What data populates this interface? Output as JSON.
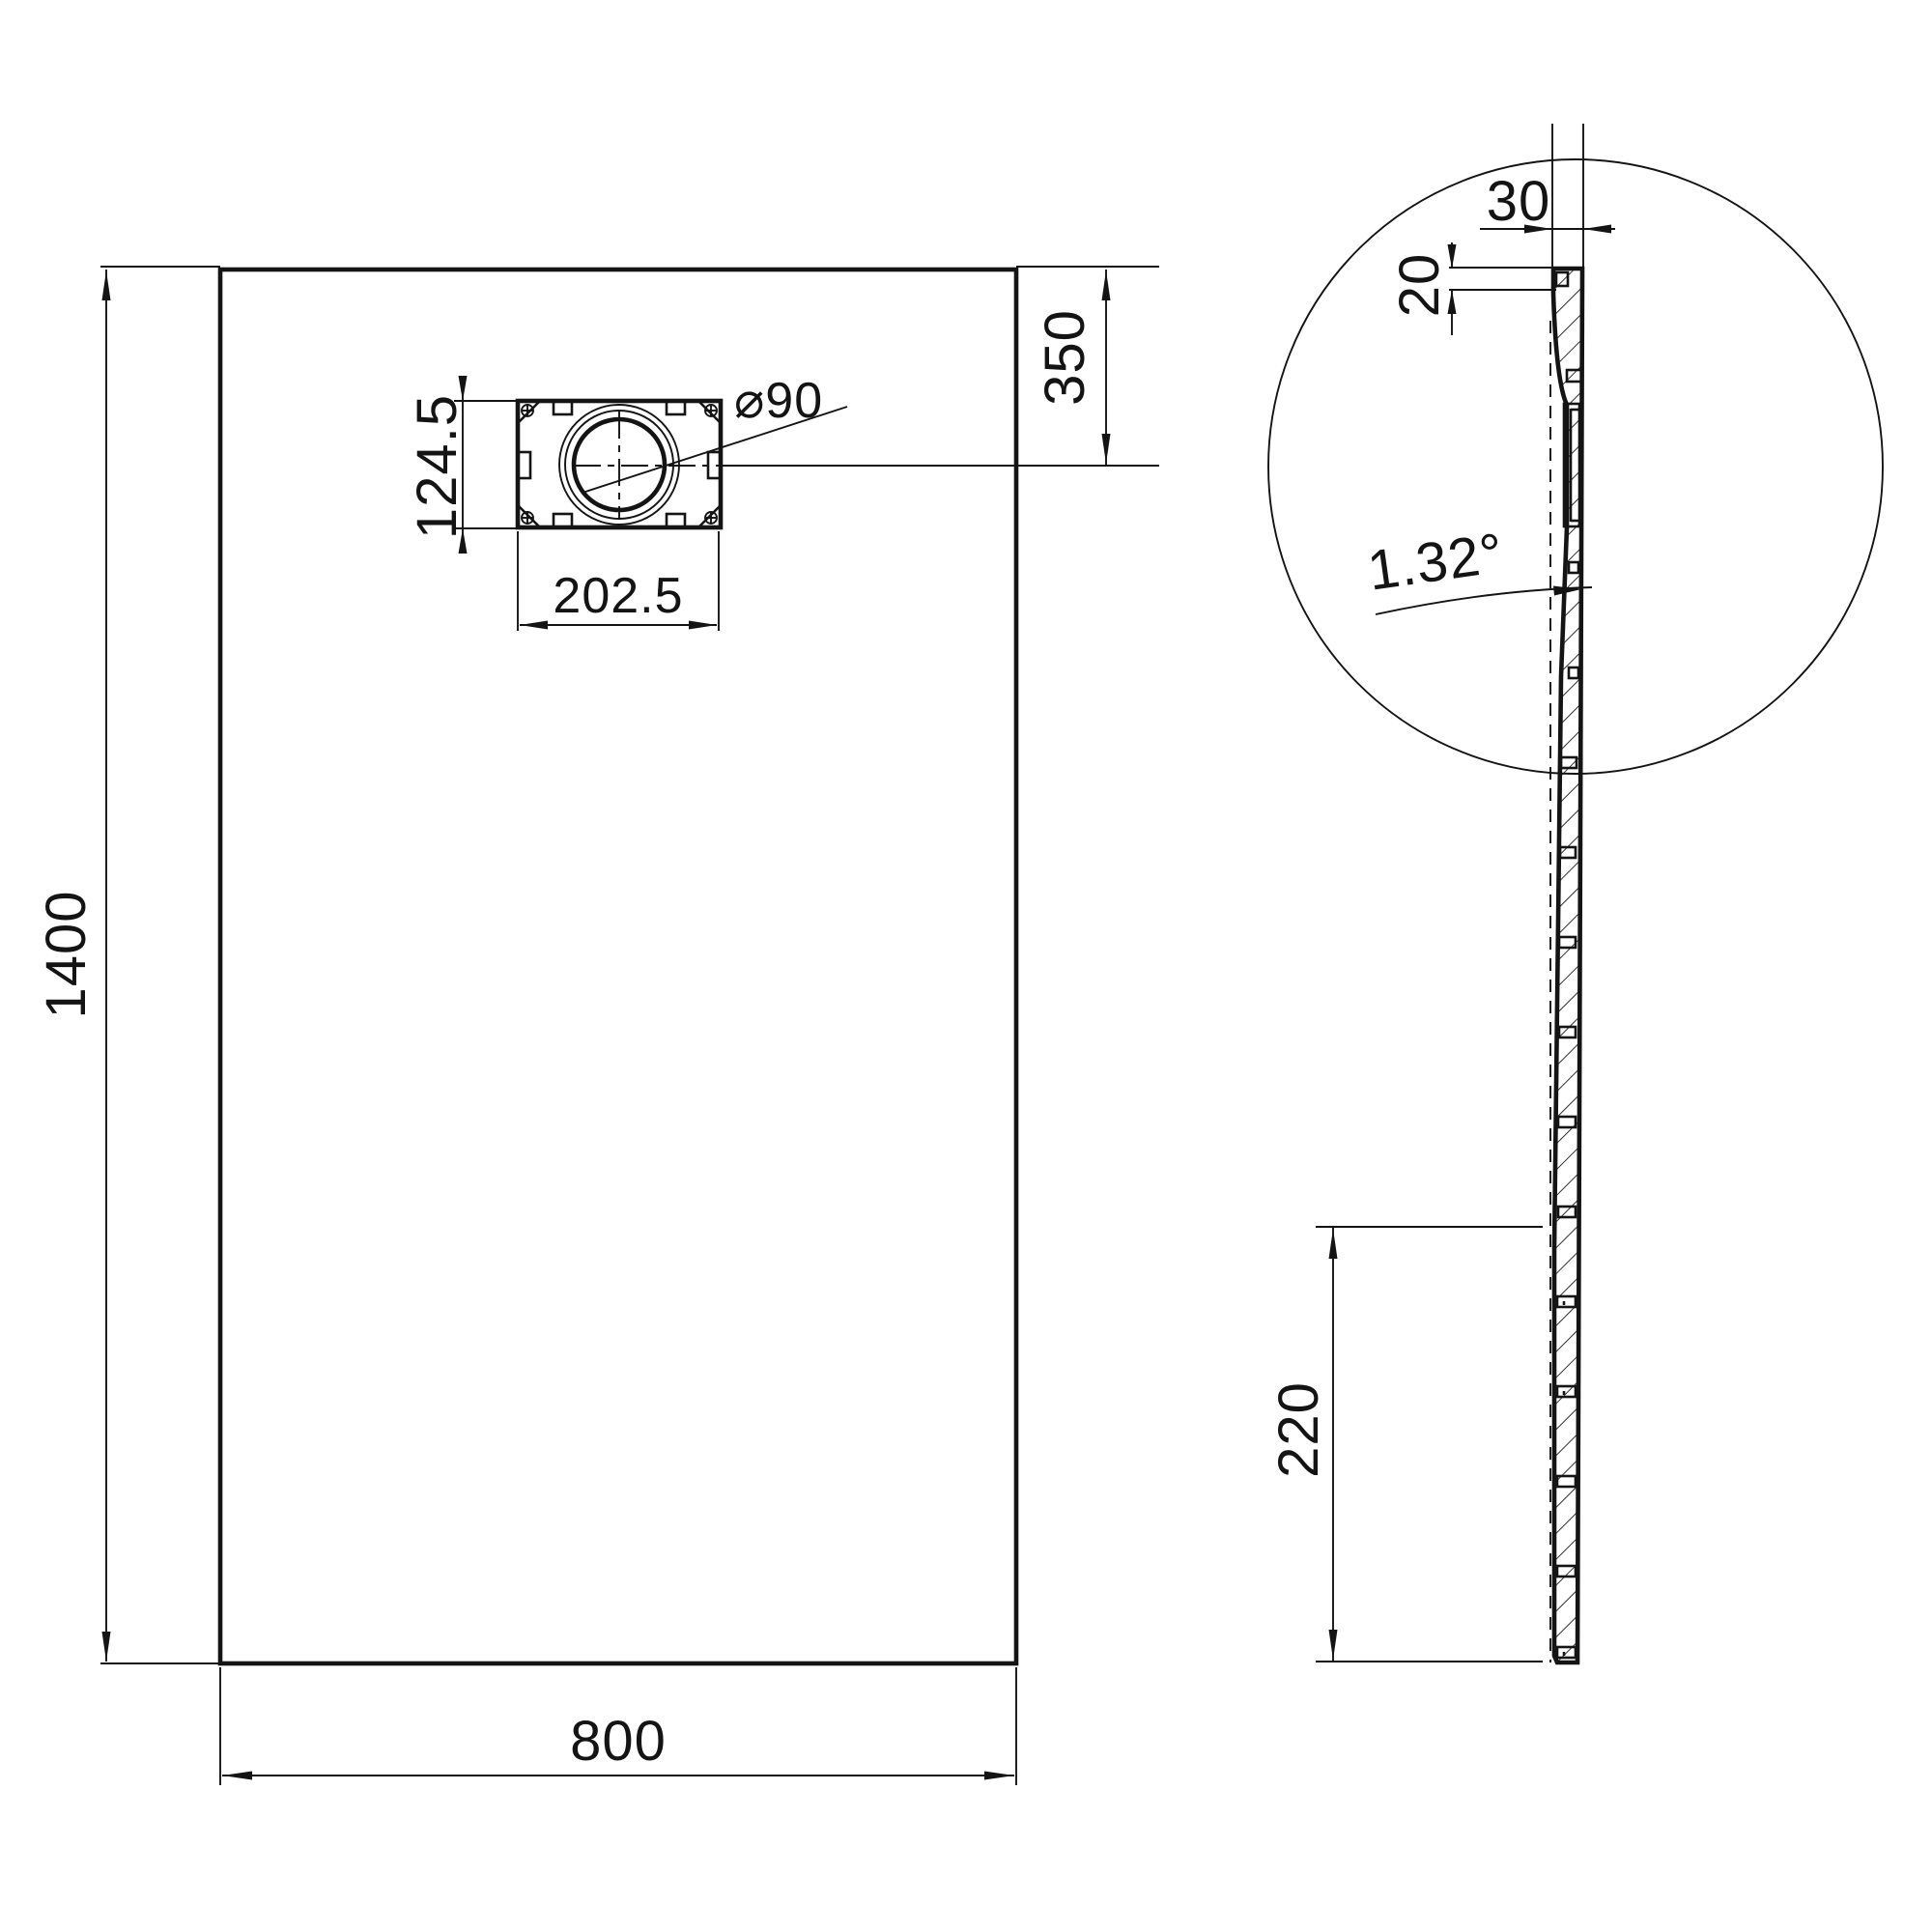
{
  "drawing": {
    "front_view": {
      "dim_height": "1400",
      "dim_width": "800",
      "dim_drain_offset_from_top": "350",
      "drain": {
        "dim_flange_height": "124.5",
        "dim_flange_width": "202.5",
        "dim_hole_diameter": "⌀90"
      }
    },
    "side_view": {
      "dim_edge_thickness": "30",
      "dim_lip_height": "20",
      "dim_slope_angle": "1.32°",
      "dim_bottom_offset": "220"
    }
  }
}
